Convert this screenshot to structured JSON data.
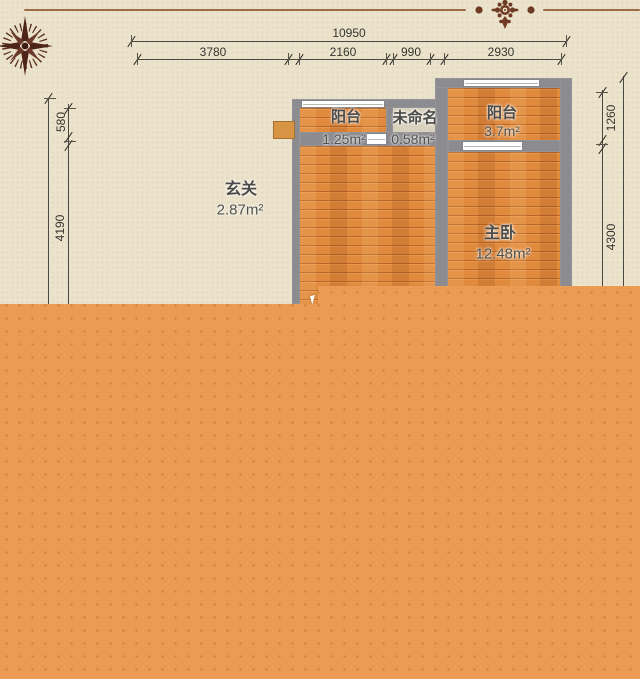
{
  "page": {
    "type": "residential-floor-plan",
    "background_color": "#ece3cc",
    "overlay_color": "#ec9b55"
  },
  "decor": {
    "ornament_icon": "damask-flower-ornament",
    "compass_icon": "compass-rose",
    "border_color": "#9a6c48"
  },
  "dimensions": {
    "top": {
      "total": "10950",
      "segments": [
        "3780",
        "2160",
        "990",
        "2930"
      ]
    },
    "left": {
      "segments": [
        "580",
        "4190"
      ]
    },
    "right": {
      "segments": [
        "1260",
        "4300"
      ]
    }
  },
  "rooms": [
    {
      "name": "阳台",
      "area": "1.25m²"
    },
    {
      "name": "未命名",
      "area": "0.58m²"
    },
    {
      "name": "阳台",
      "area": "3.7m²"
    },
    {
      "name": "玄关",
      "area": "2.87m²"
    },
    {
      "name": "主卧",
      "area": "12.48m²"
    }
  ],
  "colors": {
    "wall": "#8b8b90",
    "wood_floor": "#e08a3e",
    "unnamed_floor": "#d8d1be",
    "dimension_text": "#34342e"
  }
}
